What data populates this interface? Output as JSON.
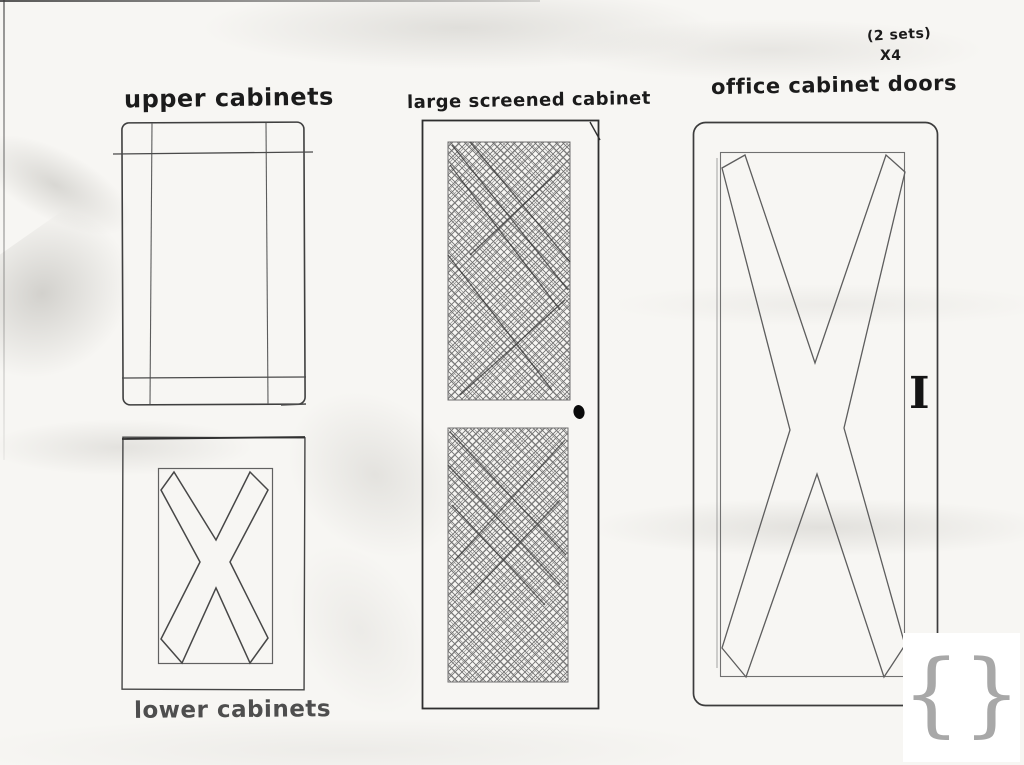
{
  "colors": {
    "paper": "#f7f6f3",
    "pencil": "#5a5a5a",
    "ink": "#1b1b1b",
    "logo_brace": "#a8a8a8",
    "logo_bird": "#141414"
  },
  "labels": {
    "upper_cabinets": "upper cabinets",
    "large_screened_cabinet": "large screened cabinet",
    "office_cabinet_doors": "office cabinet doors",
    "lower_cabinets": "lower cabinets",
    "sets_note": "(2 sets)",
    "quantity_note": "X4",
    "dimension_mark": "I"
  },
  "logo": {
    "left_brace": "{",
    "right_brace": "}",
    "icon": "bird-icon"
  }
}
